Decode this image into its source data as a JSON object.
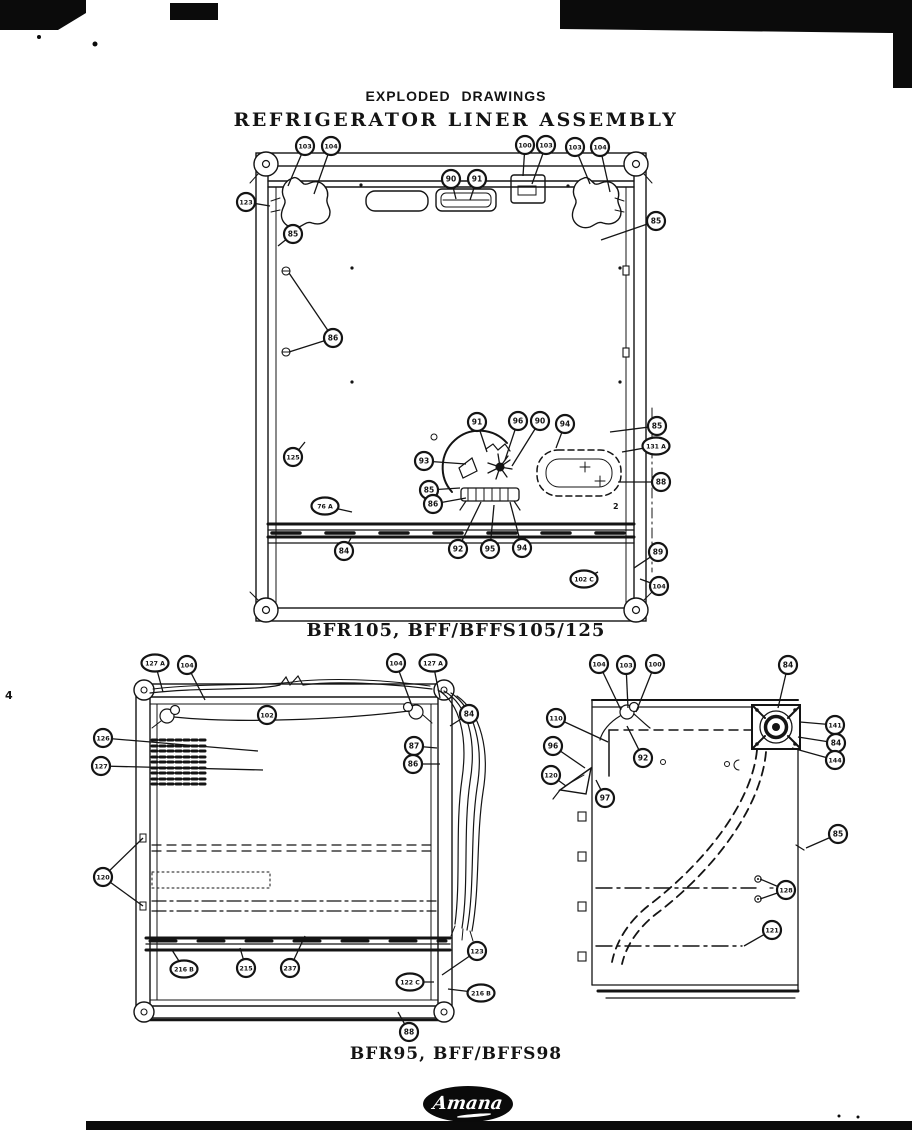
{
  "page": {
    "header": "EXPLODED DRAWINGS",
    "title": "REFRIGERATOR LINER ASSEMBLY",
    "margin_mark": "4"
  },
  "logo": {
    "brand": "Amana"
  },
  "misc": {
    "fig1_mark": "2"
  },
  "figures": {
    "fig1": {
      "caption": "BFR105, BFF/BFFS105/125",
      "callouts": [
        {
          "label": "103",
          "x": 305,
          "y": 146,
          "t": [
            [
              288,
              186
            ]
          ]
        },
        {
          "label": "104",
          "x": 331,
          "y": 146,
          "t": [
            [
              314,
              194
            ]
          ]
        },
        {
          "label": "100",
          "x": 525,
          "y": 145,
          "t": [
            [
              523,
              176
            ]
          ]
        },
        {
          "label": "103",
          "x": 546,
          "y": 145,
          "t": [
            [
              532,
              184
            ]
          ]
        },
        {
          "label": "103",
          "x": 575,
          "y": 147,
          "t": [
            [
              590,
              184
            ]
          ]
        },
        {
          "label": "104",
          "x": 600,
          "y": 147,
          "t": [
            [
              610,
              192
            ]
          ]
        },
        {
          "label": "90",
          "x": 451,
          "y": 179,
          "t": [
            [
              456,
              199
            ]
          ]
        },
        {
          "label": "91",
          "x": 477,
          "y": 179,
          "t": [
            [
              470,
              200
            ]
          ]
        },
        {
          "label": "123",
          "x": 246,
          "y": 202,
          "t": [
            [
              270,
              206
            ]
          ]
        },
        {
          "label": "85",
          "x": 293,
          "y": 234,
          "t": [
            [
              278,
              246
            ]
          ]
        },
        {
          "label": "85",
          "x": 656,
          "y": 221,
          "t": [
            [
              601,
              240
            ]
          ]
        },
        {
          "label": "86",
          "x": 333,
          "y": 338,
          "t": [
            [
              289,
              273
            ],
            [
              289,
              352
            ]
          ]
        },
        {
          "label": "125",
          "x": 293,
          "y": 457,
          "t": [
            [
              305,
              442
            ]
          ]
        },
        {
          "label": "91",
          "x": 477,
          "y": 422,
          "t": [
            [
              487,
              452
            ]
          ]
        },
        {
          "label": "96",
          "x": 518,
          "y": 421,
          "t": [
            [
              505,
              460
            ]
          ]
        },
        {
          "label": "90",
          "x": 540,
          "y": 421,
          "t": [
            [
              512,
              466
            ]
          ]
        },
        {
          "label": "94",
          "x": 565,
          "y": 424,
          "t": [
            [
              556,
              448
            ]
          ]
        },
        {
          "label": "85",
          "x": 657,
          "y": 426,
          "t": [
            [
              610,
              432
            ]
          ]
        },
        {
          "label": "131 A",
          "x": 656,
          "y": 446,
          "t": [
            [
              622,
              452
            ]
          ]
        },
        {
          "label": "93",
          "x": 424,
          "y": 461,
          "t": [
            [
              466,
              464
            ]
          ]
        },
        {
          "label": "88",
          "x": 661,
          "y": 482,
          "t": [
            [
              618,
              482
            ]
          ]
        },
        {
          "label": "85",
          "x": 429,
          "y": 490,
          "t": [
            [
              460,
              488
            ]
          ]
        },
        {
          "label": "86",
          "x": 433,
          "y": 504,
          "t": [
            [
              466,
              498
            ]
          ]
        },
        {
          "label": "76 A",
          "x": 325,
          "y": 506,
          "t": [
            [
              352,
              512
            ]
          ]
        },
        {
          "label": "84",
          "x": 344,
          "y": 551,
          "t": [
            [
              352,
              536
            ]
          ]
        },
        {
          "label": "92",
          "x": 458,
          "y": 549,
          "t": [
            [
              481,
              502
            ]
          ]
        },
        {
          "label": "95",
          "x": 490,
          "y": 549,
          "t": [
            [
              494,
              505
            ]
          ]
        },
        {
          "label": "94",
          "x": 522,
          "y": 548,
          "t": [
            [
              510,
              502
            ]
          ]
        },
        {
          "label": "89",
          "x": 658,
          "y": 552,
          "t": [
            [
              634,
              568
            ]
          ]
        },
        {
          "label": "102 C",
          "x": 584,
          "y": 579,
          "t": [
            [
              598,
              572
            ]
          ]
        },
        {
          "label": "104",
          "x": 659,
          "y": 586,
          "t": [
            [
              640,
              579
            ]
          ]
        }
      ]
    },
    "fig2": {
      "caption": "BFR95, BFF/BFFS98",
      "left_callouts": [
        {
          "label": "127 A",
          "x": 155,
          "y": 663,
          "t": [
            [
              163,
              692
            ]
          ]
        },
        {
          "label": "104",
          "x": 187,
          "y": 665,
          "t": [
            [
              205,
              700
            ]
          ]
        },
        {
          "label": "102",
          "x": 267,
          "y": 715,
          "t": []
        },
        {
          "label": "104",
          "x": 396,
          "y": 663,
          "t": [
            [
              412,
              706
            ]
          ]
        },
        {
          "label": "127 A",
          "x": 433,
          "y": 663,
          "t": [
            [
              440,
              698
            ]
          ]
        },
        {
          "label": "84",
          "x": 469,
          "y": 714,
          "t": [
            [
              450,
              726
            ]
          ]
        },
        {
          "label": "126",
          "x": 103,
          "y": 738,
          "t": [
            [
              258,
              751
            ]
          ]
        },
        {
          "label": "87",
          "x": 414,
          "y": 746,
          "t": [
            [
              437,
              748
            ]
          ]
        },
        {
          "label": "86",
          "x": 413,
          "y": 764,
          "t": [
            [
              440,
              764
            ]
          ]
        },
        {
          "label": "127",
          "x": 101,
          "y": 766,
          "t": [
            [
              263,
              770
            ]
          ]
        },
        {
          "label": "120",
          "x": 103,
          "y": 877,
          "t": [
            [
              143,
              838
            ],
            [
              143,
              906
            ]
          ]
        },
        {
          "label": "216 B",
          "x": 184,
          "y": 969,
          "t": [
            [
              172,
              950
            ]
          ]
        },
        {
          "label": "215",
          "x": 246,
          "y": 968,
          "t": [
            [
              240,
              948
            ]
          ]
        },
        {
          "label": "237",
          "x": 290,
          "y": 968,
          "t": [
            [
              305,
              936
            ]
          ]
        },
        {
          "label": "123",
          "x": 477,
          "y": 951,
          "t": [
            [
              442,
              975
            ]
          ]
        },
        {
          "label": "122 C",
          "x": 410,
          "y": 982,
          "t": [
            [
              434,
              982
            ]
          ]
        },
        {
          "label": "216 B",
          "x": 481,
          "y": 993,
          "t": [
            [
              448,
              989
            ]
          ]
        },
        {
          "label": "88",
          "x": 409,
          "y": 1032,
          "t": [
            [
              398,
              1012
            ]
          ]
        }
      ],
      "right_callouts": [
        {
          "label": "104",
          "x": 599,
          "y": 664,
          "t": [
            [
              621,
              710
            ]
          ]
        },
        {
          "label": "103",
          "x": 626,
          "y": 665,
          "t": [
            [
              628,
              708
            ]
          ]
        },
        {
          "label": "100",
          "x": 655,
          "y": 664,
          "t": [
            [
              636,
              712
            ]
          ]
        },
        {
          "label": "84",
          "x": 788,
          "y": 665,
          "t": [
            [
              778,
              708
            ]
          ]
        },
        {
          "label": "110",
          "x": 556,
          "y": 718,
          "t": [
            [
              608,
              742
            ]
          ]
        },
        {
          "label": "96",
          "x": 553,
          "y": 746,
          "t": [
            [
              585,
              768
            ]
          ]
        },
        {
          "label": "120",
          "x": 551,
          "y": 775,
          "t": [
            [
              566,
              786
            ]
          ]
        },
        {
          "label": "97",
          "x": 605,
          "y": 798,
          "t": [
            [
              596,
              780
            ]
          ]
        },
        {
          "label": "92",
          "x": 643,
          "y": 758,
          "t": [
            [
              627,
              726
            ]
          ]
        },
        {
          "label": "141",
          "x": 835,
          "y": 725,
          "t": [
            [
              800,
              722
            ]
          ]
        },
        {
          "label": "84",
          "x": 836,
          "y": 743,
          "t": [
            [
              798,
              737
            ]
          ]
        },
        {
          "label": "144",
          "x": 835,
          "y": 760,
          "t": [
            [
              792,
              748
            ]
          ]
        },
        {
          "label": "85",
          "x": 838,
          "y": 834,
          "t": [
            [
              806,
              848
            ]
          ]
        },
        {
          "label": "128",
          "x": 786,
          "y": 890,
          "t": [
            [
              760,
              879
            ],
            [
              760,
              899
            ]
          ]
        },
        {
          "label": "121",
          "x": 772,
          "y": 930,
          "t": [
            [
              744,
              946
            ]
          ]
        }
      ]
    }
  }
}
